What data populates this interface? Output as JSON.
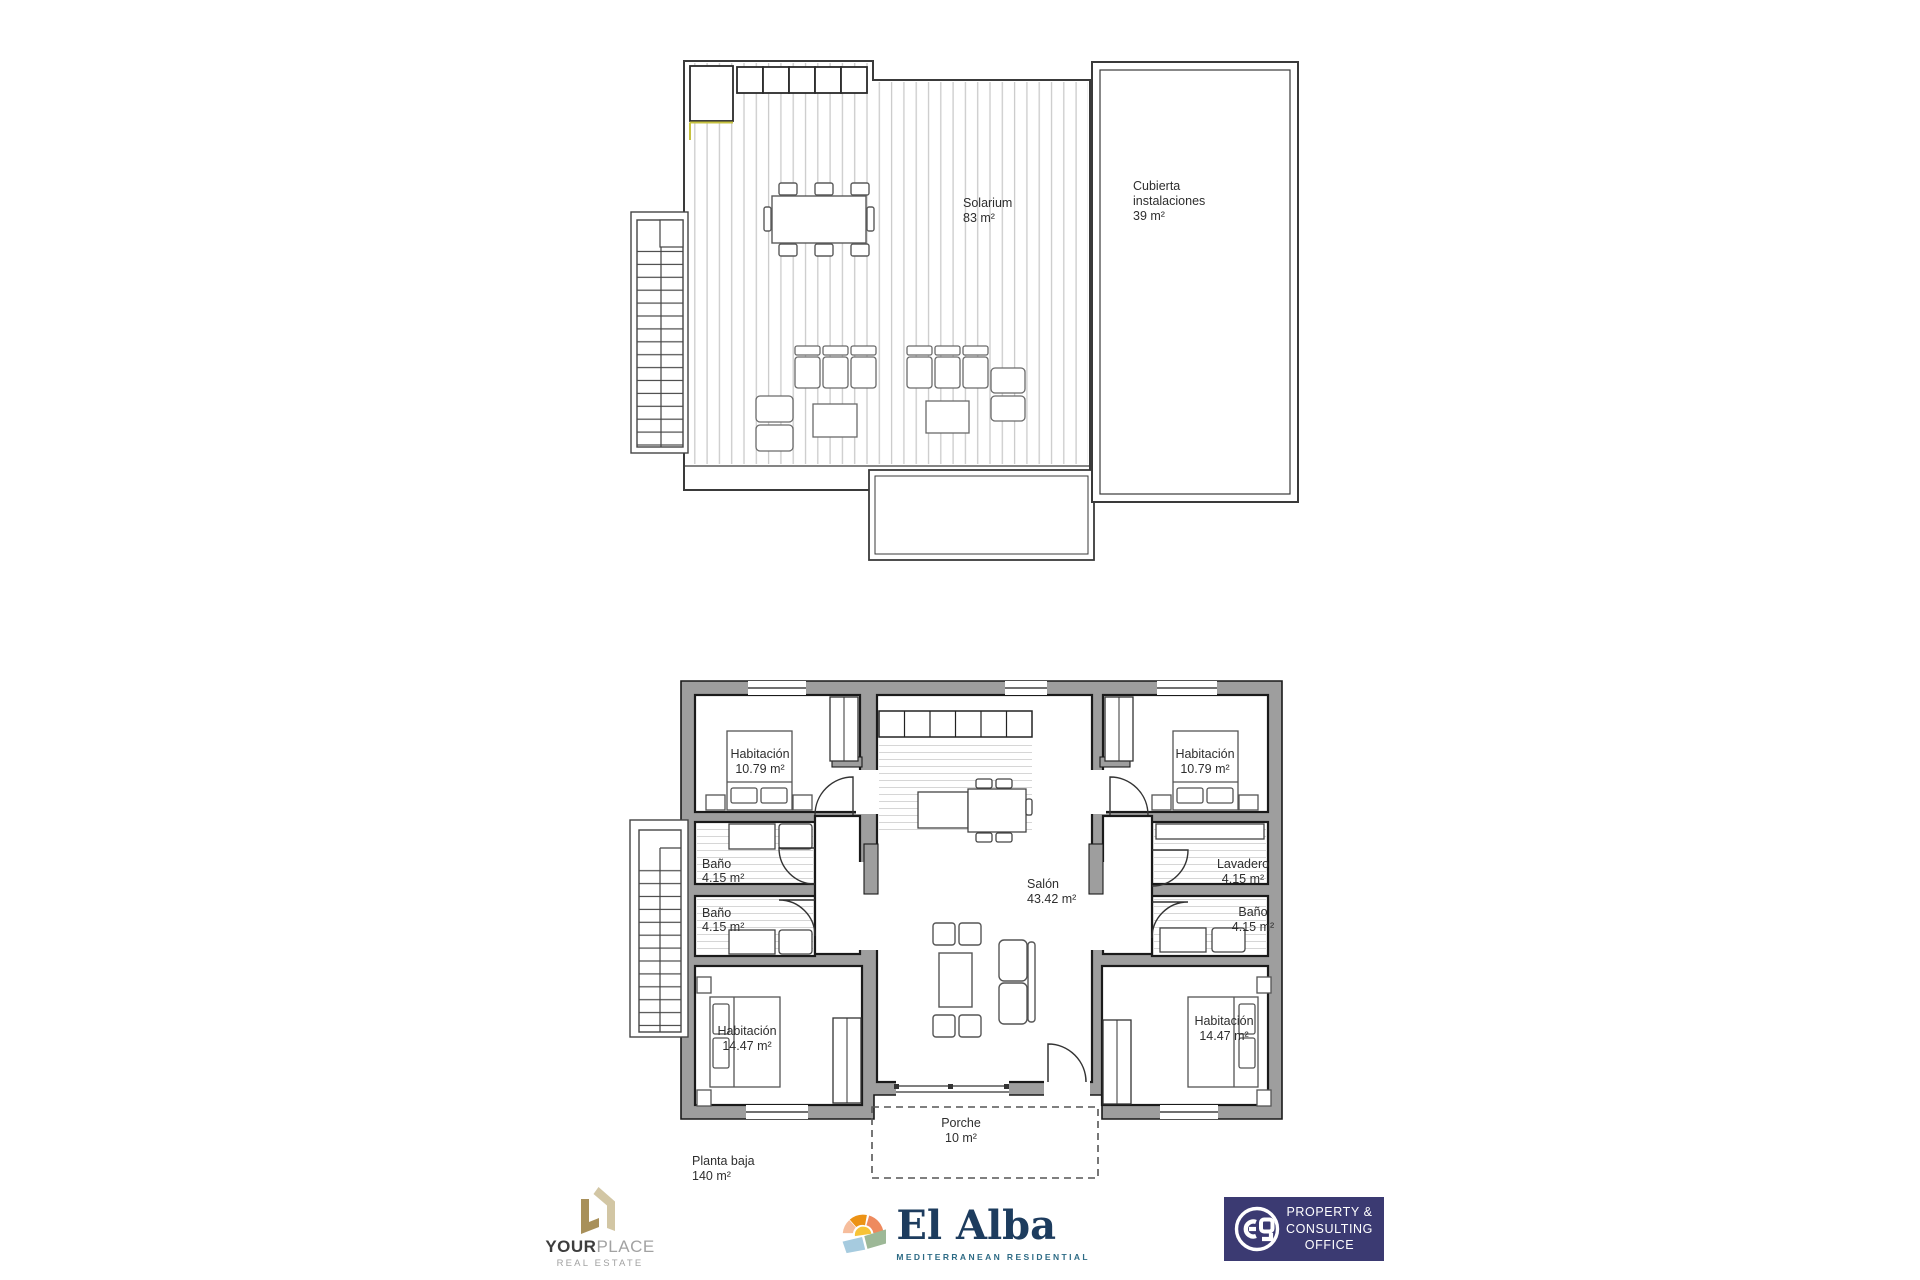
{
  "solarium_plan": {
    "solarium": {
      "name": "Solarium",
      "area": "83 m²"
    },
    "cubierta": {
      "line1": "Cubierta",
      "line2": "instalaciones",
      "area": "39 m²"
    }
  },
  "ground_plan": {
    "floor": {
      "name": "Planta baja",
      "area": "140 m²"
    },
    "bedroom_tl": {
      "name": "Habitación",
      "area": "10.79 m²"
    },
    "bedroom_tr": {
      "name": "Habitación",
      "area": "10.79 m²"
    },
    "bano_l1": {
      "name": "Baño",
      "area": "4.15 m²"
    },
    "bano_l2": {
      "name": "Baño",
      "area": "4.15 m²"
    },
    "lavadero": {
      "name": "Lavadero",
      "area": "4.15 m²"
    },
    "bano_r": {
      "name": "Baño",
      "area": "4.15 m²"
    },
    "bedroom_bl": {
      "name": "Habitación",
      "area": "14.47 m²"
    },
    "bedroom_br": {
      "name": "Habitación",
      "area": "14.47 m²"
    },
    "salon": {
      "name": "Salón",
      "area": "43.42 m²"
    },
    "porche": {
      "name": "Porche",
      "area": "10 m²"
    }
  },
  "logos": {
    "yourplace": {
      "brand_bold": "YOUR",
      "brand_light": "PLACE",
      "tagline": "REAL ESTATE",
      "gold": "#a8905a",
      "tan": "#d2c6a4"
    },
    "elalba": {
      "name": "El Alba",
      "tagline": "MEDITERRANEAN RESIDENTIAL",
      "navy": "#1d3c5e",
      "teal": "#2d6b85",
      "orange": "#ec9215",
      "coral": "#ee8a5e",
      "peach": "#f6bd9c",
      "yellow": "#f7c337",
      "blue": "#a6cbdf",
      "green": "#9db897"
    },
    "pco": {
      "line1": "PROPERTY &",
      "line2": "CONSULTING",
      "line3": "OFFICE",
      "bg": "#3b3a72"
    }
  },
  "colors": {
    "wall_gray": "#9e9e9e",
    "deck_line": "#cbcbcb",
    "accent_yellow": "#c6c13f",
    "outline": "#3a3a3a"
  }
}
